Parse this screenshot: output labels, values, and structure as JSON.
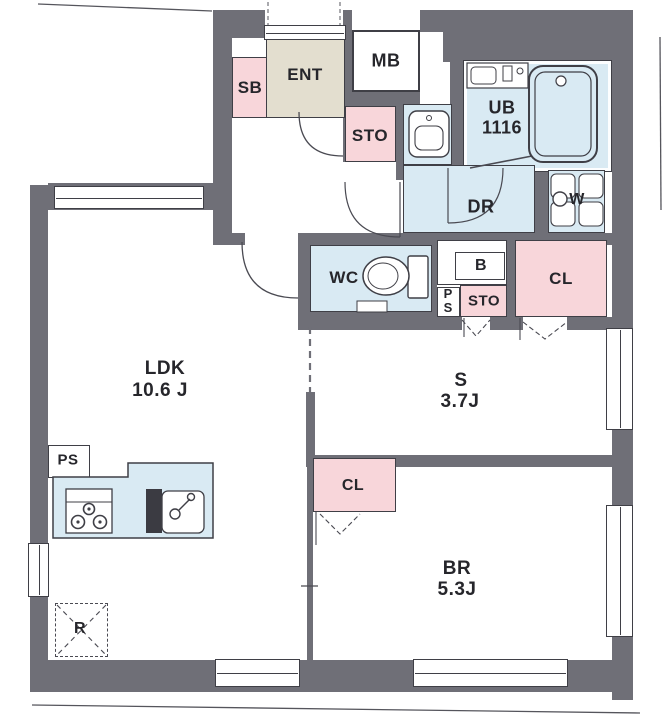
{
  "colors": {
    "wall": "#6f6f77",
    "wet_room_blue": "#d9eaf3",
    "closet_pink": "#f8d6da",
    "entrance_beige": "#e3decf",
    "line": "#3f3f46"
  },
  "rooms": {
    "ldk": {
      "label": "LDK",
      "area": "10.6 J"
    },
    "service": {
      "label": "S",
      "area": "3.7J"
    },
    "bedroom": {
      "label": "BR",
      "area": "5.3J"
    },
    "bath": {
      "label": "UB",
      "size": "1116"
    },
    "entrance": {
      "label": "ENT"
    },
    "shoe_box": {
      "label": "SB"
    },
    "meter_box": {
      "label": "MB"
    },
    "storage_entrance": {
      "label": "STO"
    },
    "dressing_room": {
      "label": "DR"
    },
    "washer": {
      "label": "W"
    },
    "toilet": {
      "label": "WC"
    },
    "board": {
      "label": "B"
    },
    "pipe_space_mid": {
      "label": "PS"
    },
    "storage_mid": {
      "label": "STO"
    },
    "closet_s": {
      "label": "CL"
    },
    "closet_br": {
      "label": "CL"
    },
    "pipe_space_ldk": {
      "label": "PS"
    },
    "refrigerator": {
      "label": "R"
    }
  }
}
